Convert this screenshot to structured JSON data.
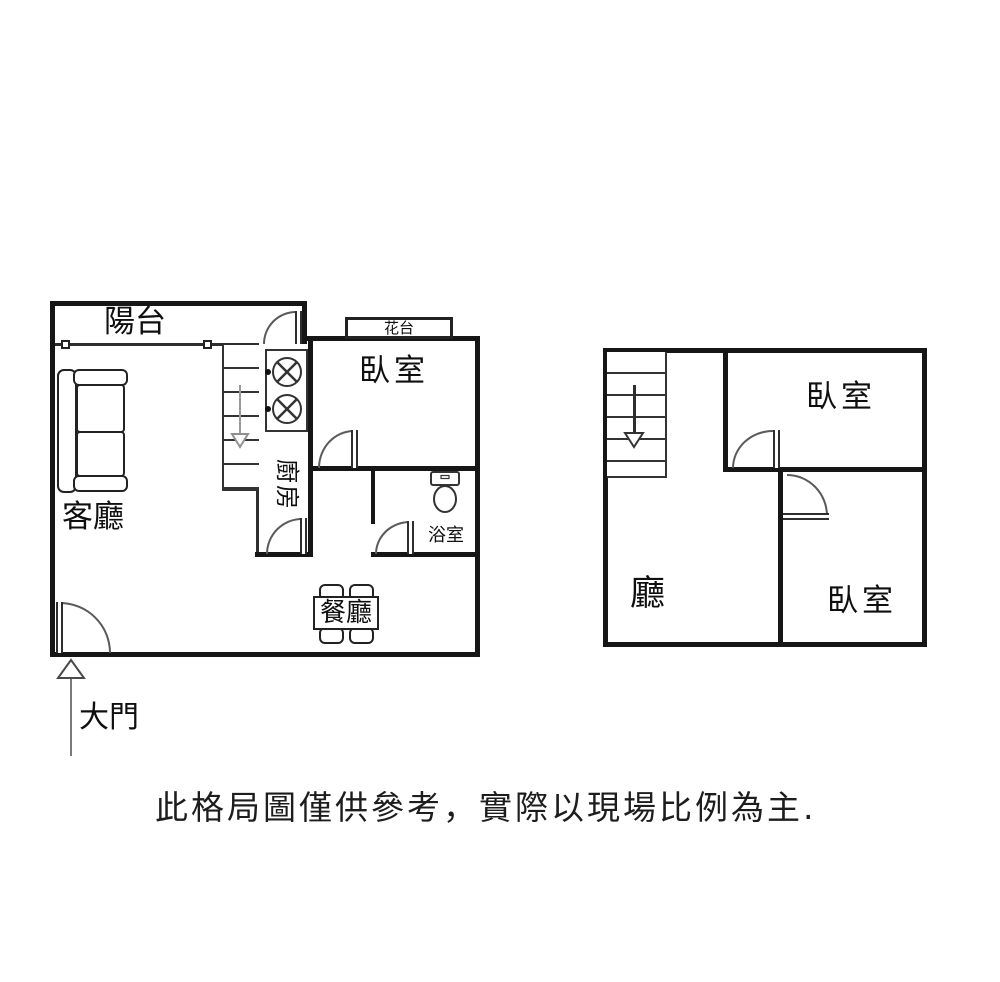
{
  "canvas": {
    "width": 1000,
    "height": 982,
    "background": "#ffffff",
    "wall_color": "#161616",
    "line_color": "#2e2e2e"
  },
  "lower_floor": {
    "balcony_label": "陽台",
    "living_room_label": "客廳",
    "kitchen_label": "廚房",
    "bedroom_label": "臥室",
    "flower_stand_label": "花台",
    "bathroom_label": "浴室",
    "dining_label": "餐廳",
    "entrance_label": "大門"
  },
  "upper_floor": {
    "hall_label": "廳",
    "bedroom_top_label": "臥室",
    "bedroom_bottom_label": "臥室"
  },
  "disclaimer": "此格局圖僅供參考，實際以現場比例為主.",
  "icons": {
    "sofa": "css-shape",
    "stove": "svg-two-burners",
    "toilet": "svg-tank-and-bowl",
    "dining_table": "css-shape-4-chairs",
    "stairs_down_arrow": "▽",
    "entrance_up_arrow": "△",
    "window_marker": "□",
    "door_swing": "quarter-arc"
  }
}
